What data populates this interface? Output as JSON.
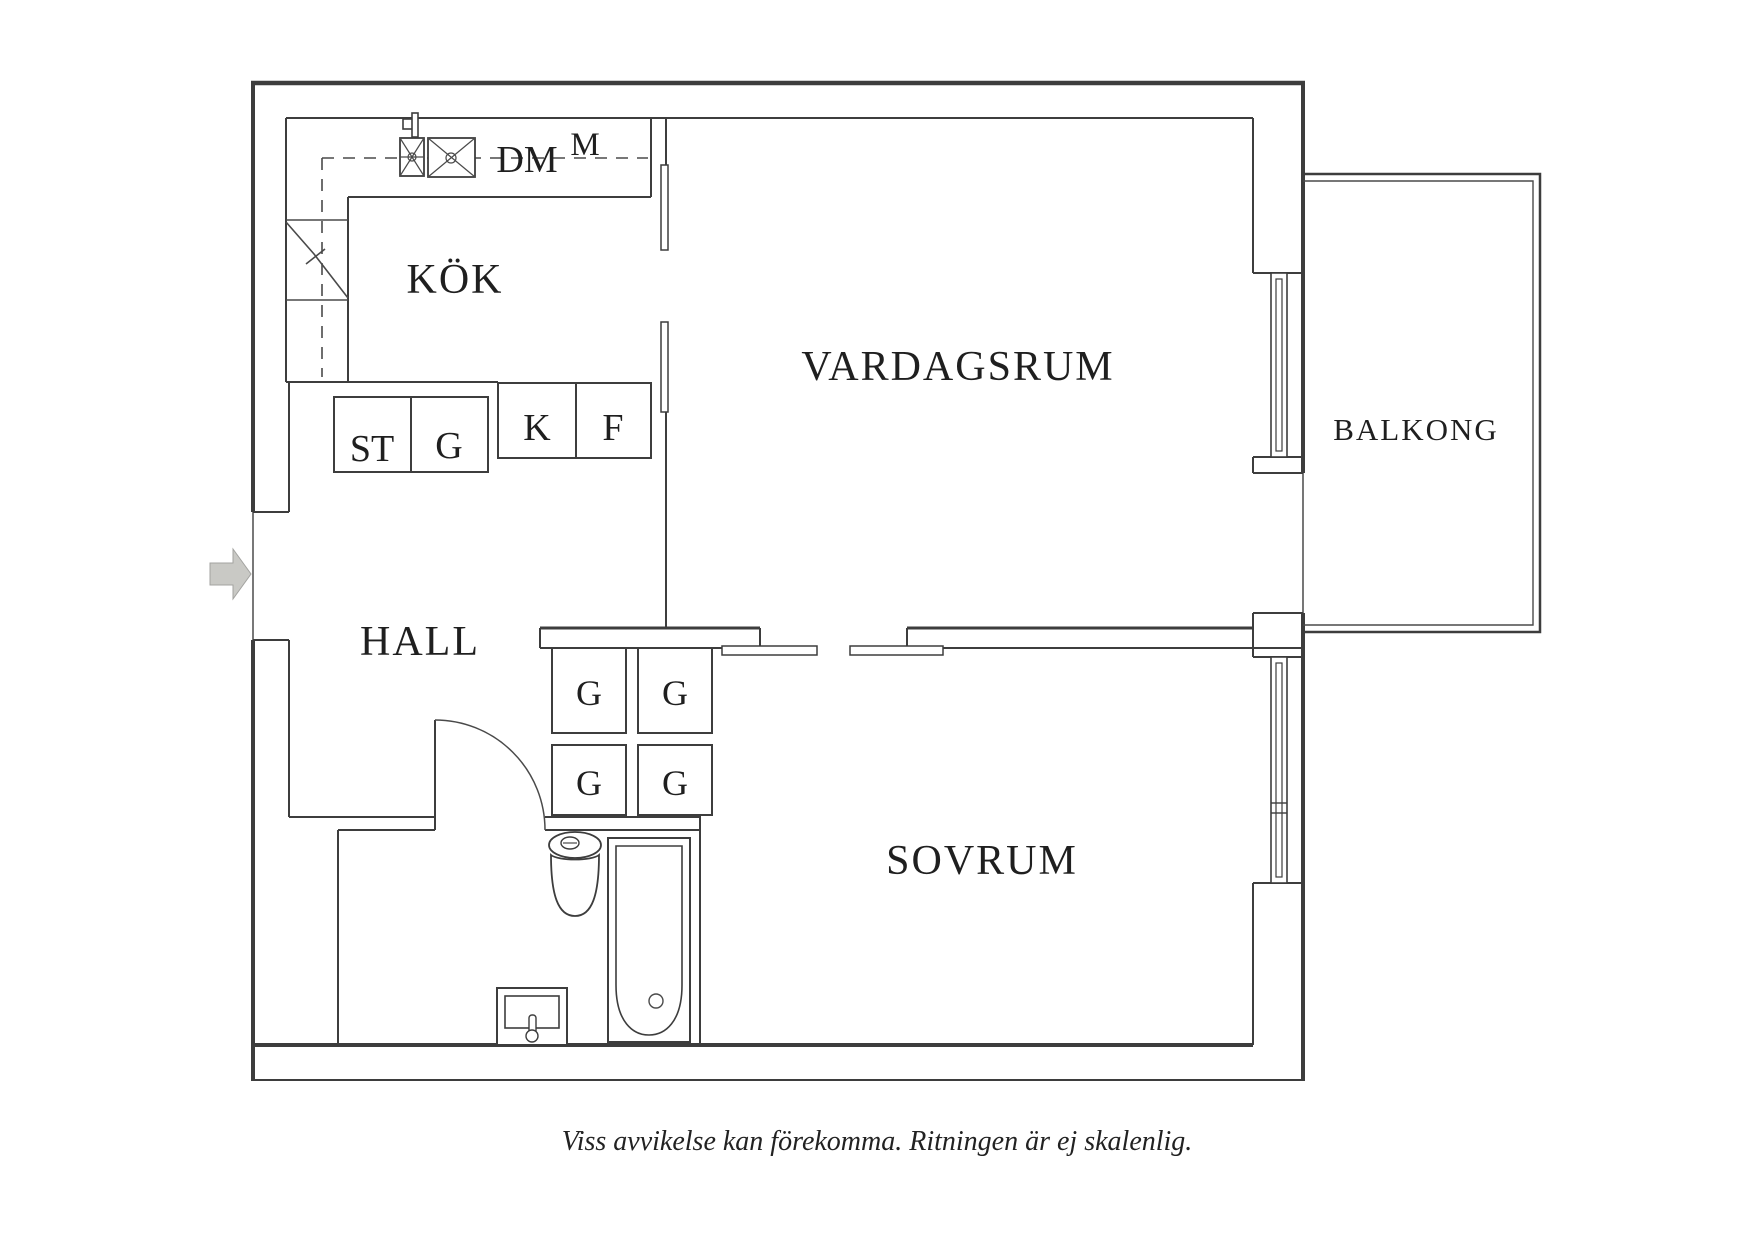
{
  "floor_plan": {
    "rooms": {
      "kitchen": "KÖK",
      "living_room": "VARDAGSRUM",
      "hall": "HALL",
      "bedroom": "SOVRUM",
      "balcony": "BALKONG"
    },
    "fixture_labels": {
      "dishwasher": "DM",
      "micro": "M",
      "cleaning_cabinet": "ST",
      "kitchen_wardrobe": "G",
      "fridge": "K",
      "freezer": "F",
      "closet_g1": "G",
      "closet_g2": "G",
      "closet_g3": "G",
      "closet_g4": "G"
    },
    "caption": "Viss avvikelse kan förekomma. Ritningen är ej skalenlig.",
    "colors": {
      "wall": "#3d3d3d",
      "text": "#1f1f1f",
      "arrow_fill": "#c9c9c5",
      "arrow_edge": "#a3a3a0",
      "background": "#ffffff"
    }
  }
}
